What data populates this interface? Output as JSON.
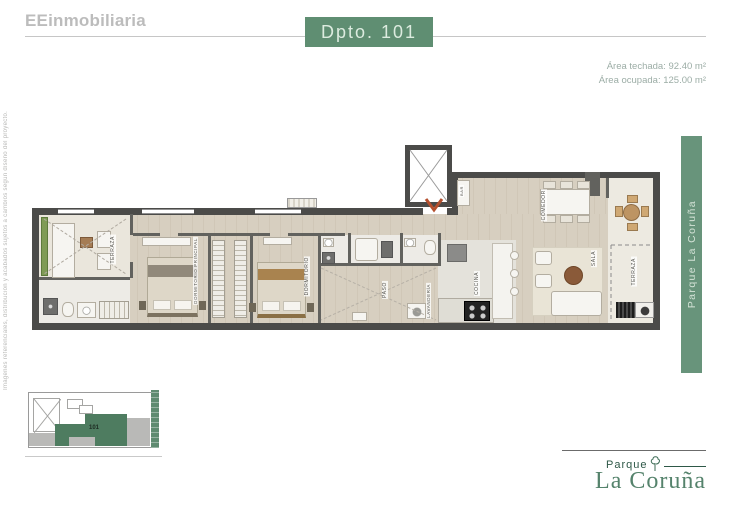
{
  "header": {
    "brand": "EEinmobiliaria",
    "unit_title": "Dpto. 101",
    "area_techada": "Área techada: 92.40 m²",
    "area_ocupada": "Área ocupada: 125.00 m²"
  },
  "left_margin": {
    "disclaimer": "Imágenes referenciales, distribución y acabados sujetos a cambios según diseño del proyecto."
  },
  "right_banner": {
    "text": "Parque La Coruña"
  },
  "plan": {
    "labels": {
      "terraza_izquierda": "TERRAZA",
      "dormitorio_principal": "DORMITORIO PRINCIPAL",
      "dormitorio": "DORMITORIO",
      "paso": "PASO",
      "lavanderia": "LAVANDERÍA",
      "cocina": "COCINA",
      "bar": "BAR",
      "comedor": "COMEDOR",
      "sala": "SALA",
      "terraza_derecha": "TERRAZA"
    }
  },
  "keyplan": {
    "unit_label": "101"
  },
  "footer": {
    "brand_small": "Parque",
    "brand_large": "La Coruña"
  },
  "colors": {
    "badge_green": "#5f8e72",
    "banner_green": "#68947b",
    "logo_green": "#55836c",
    "keyplan_unit_green": "#4e7c60",
    "planter_green": "#7f9b55",
    "entry_arrow": "#b5502e",
    "wall_dark": "#4b4b49"
  }
}
